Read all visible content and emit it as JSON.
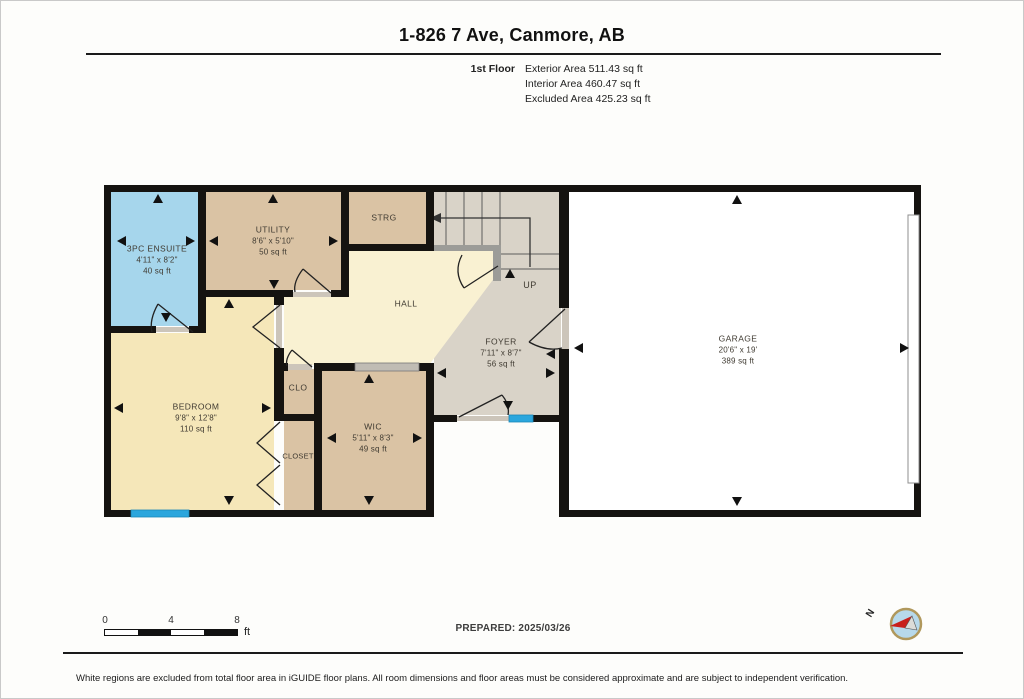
{
  "header": {
    "title": "1-826 7 Ave, Canmore, AB",
    "floor_label": "1st Floor",
    "areas": [
      {
        "label": "Exterior Area 511.43 sq ft"
      },
      {
        "label": "Interior Area 460.47 sq ft"
      },
      {
        "label": "Excluded Area 425.23 sq ft"
      }
    ]
  },
  "rooms": {
    "ensuite": {
      "name": "3PC ENSUITE",
      "dims": "4'11\" x 8'2\"",
      "area": "40 sq ft"
    },
    "utility": {
      "name": "UTILITY",
      "dims": "8'6\" x 5'10\"",
      "area": "50 sq ft"
    },
    "strg": {
      "name": "STRG"
    },
    "hall": {
      "name": "HALL"
    },
    "up": {
      "name": "UP"
    },
    "foyer": {
      "name": "FOYER",
      "dims": "7'11\" x 8'7\"",
      "area": "56 sq ft"
    },
    "garage": {
      "name": "GARAGE",
      "dims": "20'6\" x 19'",
      "area": "389 sq ft"
    },
    "bedroom": {
      "name": "BEDROOM",
      "dims": "9'8\" x 12'8\"",
      "area": "110 sq ft"
    },
    "clo": {
      "name": "CLO"
    },
    "closet": {
      "name": "CLOSET"
    },
    "wic": {
      "name": "WIC",
      "dims": "5'11\" x 8'3\"",
      "area": "49 sq ft"
    }
  },
  "scale_bar": {
    "ticks": [
      "0",
      "4",
      "8"
    ],
    "unit": "ft"
  },
  "prepared": {
    "label": "PREPARED: 2025/03/26"
  },
  "compass": {
    "north_label": "N"
  },
  "footer": {
    "disclaimer": "White regions are excluded from total floor area in iGUIDE floor plans. All room dimensions and floor areas must be considered approximate and are subject to independent verification."
  },
  "colors": {
    "wall": "#151310",
    "ensuite_fill": "#a6d6ec",
    "tan_fill": "#dac3a4",
    "hall_fill": "#f9f1d2",
    "bedroom_fill": "#f5e7b9",
    "foyer_fill": "#d9d3c8",
    "garage_fill": "#ffffff",
    "window_blue": "#2ba6dd",
    "rail_gray": "#9c9c98",
    "threshold": "#ccc5ba",
    "compass_ring": "#b0985c",
    "compass_fill": "#b7d9eb",
    "compass_needle": "#c8201c"
  }
}
